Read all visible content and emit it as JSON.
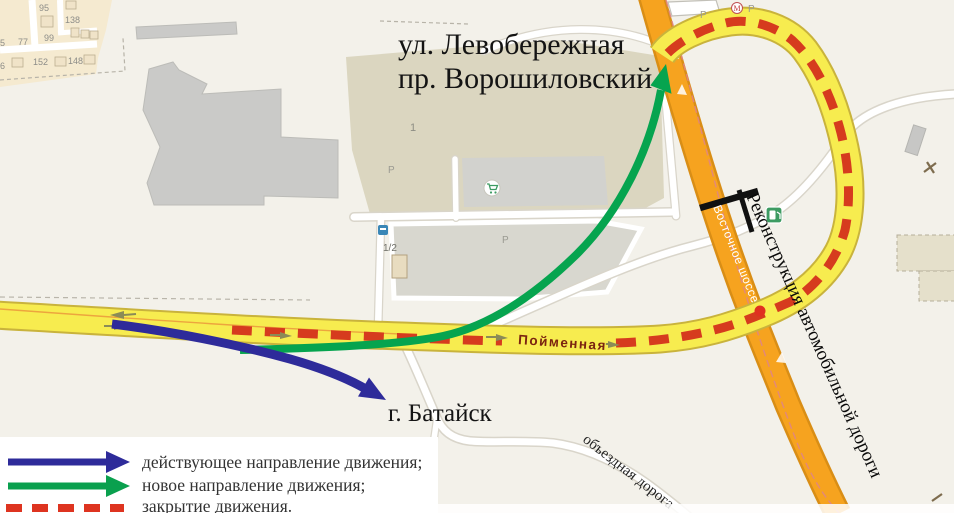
{
  "map": {
    "title": {
      "line1": "ул. Левобережная",
      "line2": "пр. Ворошиловский"
    },
    "city": "г. Батайск",
    "roads": {
      "poimennaya": "Пойменная",
      "vostochnoye": "Восточное шоссе",
      "obyezdnaya": "объездная дорога"
    },
    "reconstruction_note": "Реконструкция автомобильной дороги",
    "parcel_one": "1",
    "parcel_half": "1/2",
    "parking_label": "P",
    "metro_label": "М",
    "house_numbers": [
      "95",
      "138",
      "77",
      "99",
      "152",
      "148",
      "5",
      "6"
    ]
  },
  "legend": {
    "items": [
      {
        "label": "действующее направление движения;",
        "color": "#2e2b9a",
        "type": "arrow"
      },
      {
        "label": "новое направление движения;",
        "color": "#0aa04e",
        "type": "arrow"
      },
      {
        "label": "закрытие движения.",
        "color": "#de3420",
        "type": "dashed"
      }
    ]
  },
  "colors": {
    "background": "#f3f1ea",
    "road_yellow": "#f7ec4f",
    "road_yellow_casing": "#c9b33c",
    "road_orange": "#f6a31f",
    "road_orange_casing": "#d98e16",
    "closure_red": "#d63b1e",
    "arrow_current_blue": "#2e2b9a",
    "arrow_new_green": "#06a44f",
    "residential_tan": "#f5ead0",
    "industrial_gray": "#cacac8",
    "poi_green": "#3d9b62"
  }
}
